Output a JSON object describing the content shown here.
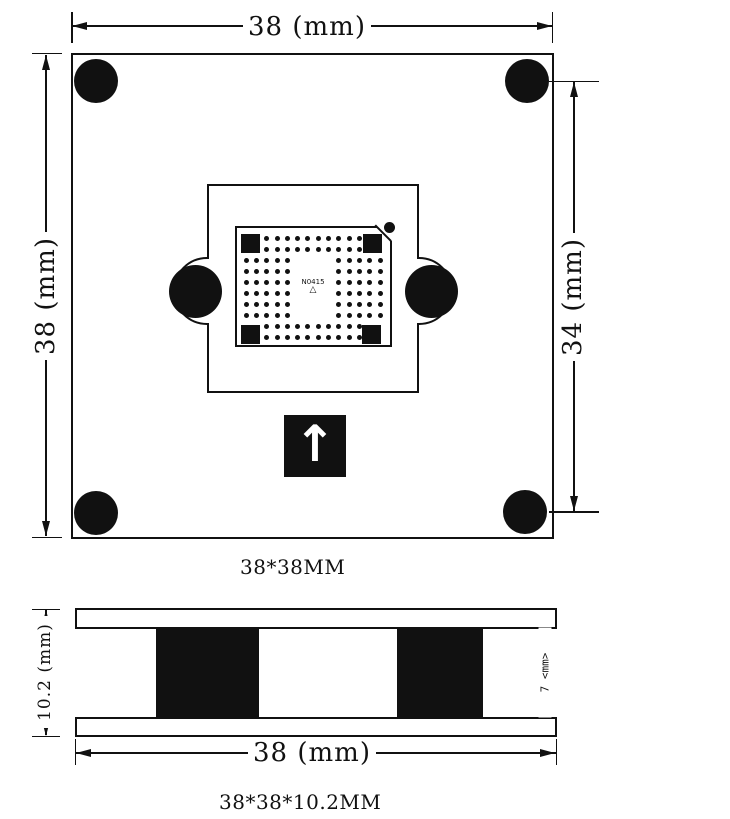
{
  "colors": {
    "ink": "#111111",
    "bg": "#ffffff"
  },
  "top_view": {
    "dim_top": "38 (mm)",
    "dim_left": "38 (mm)",
    "dim_right": "34 (mm)",
    "chip_marking": "N0415",
    "chip_index": "△",
    "orientation_arrow": "↑",
    "caption": "38*38MM",
    "pad_grid_rows": [
      "..##########..",
      "..##########..",
      "#####....#####",
      "#####....#####",
      "#####....#####",
      "#####....#####",
      "#####....#####",
      "#####....#####",
      "..##########..",
      "..##########.."
    ]
  },
  "side_view": {
    "dim_left": "10.2 (mm)",
    "dim_right": "7 <mm>",
    "dim_bottom": "38 (mm)",
    "caption": "38*38*10.2MM"
  }
}
